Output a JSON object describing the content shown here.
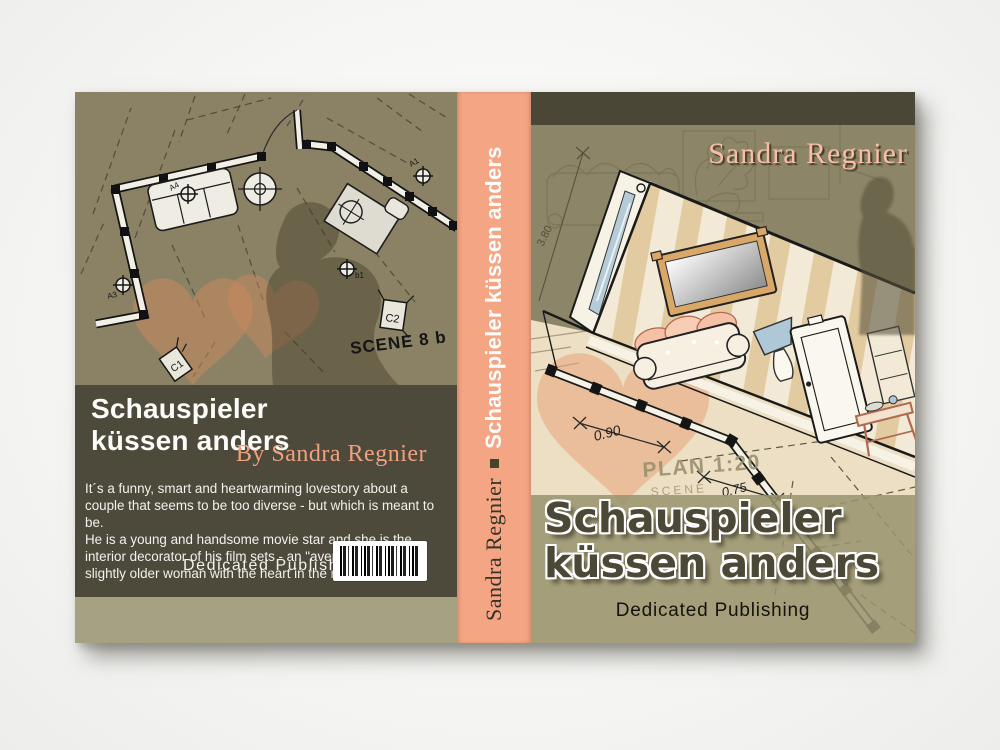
{
  "back": {
    "title_line1": "Schauspieler",
    "title_line2": "küssen anders",
    "byline": "By Sandra Regnier",
    "blurb_p1": "It´s a funny, smart and heartwarming lovestory about a couple that seems to be too diverse - but which is meant to be.",
    "blurb_p2": "He is a young and handsome movie star and she is the interior decorator of his film sets - an \"average\" looking slightly older woman with the heart in the right place.",
    "publisher": "Dedicated Publishing",
    "plan": {
      "scene_label": "SCENE 8 b",
      "camera1": "C1",
      "camera2": "C2",
      "light_b1": "b1",
      "light_a4": "A4",
      "light_a3": "A3",
      "light_a1": "A1"
    }
  },
  "spine": {
    "author": "Sandra Regnier",
    "title": "Schauspieler küssen anders"
  },
  "front": {
    "author": "Sandra Regnier",
    "title_line1": "Schauspieler",
    "title_line2": "küssen anders",
    "publisher": "Dedicated Publishing",
    "plan": {
      "height_dim": "3.80",
      "width_dim1": "0.90",
      "width_dim2": "0.75",
      "plan_label": "PLAN 1:20",
      "scene_label": "SCENE"
    }
  },
  "colors": {
    "spine_salmon": "#F4A584",
    "olive": "#8B8265",
    "dark_band": "#4D4A3C",
    "cream_paper": "#ECDFC3",
    "accent_salmon": "#EFA17E",
    "heart": "#D08A5E"
  }
}
